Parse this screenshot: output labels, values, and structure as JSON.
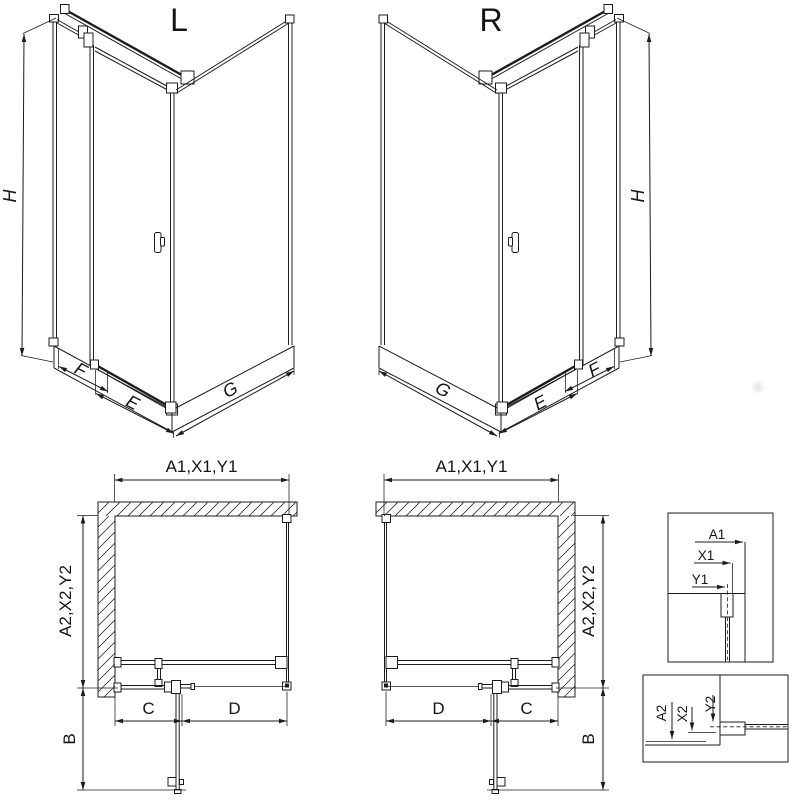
{
  "drawing": {
    "iso_left": {
      "label": "L",
      "dim_height": "H",
      "dim_side_panel": "F",
      "dim_door": "E",
      "dim_wall": "G"
    },
    "iso_right": {
      "label": "R",
      "dim_height": "H",
      "dim_side_panel": "F",
      "dim_door": "E",
      "dim_wall": "G"
    },
    "plan_left": {
      "dim_top": "A1,X1,Y1",
      "dim_side": "A2,X2,Y2",
      "dim_fixed": "C",
      "dim_door": "D",
      "dim_depth": "B"
    },
    "plan_right": {
      "dim_top": "A1,X1,Y1",
      "dim_side": "A2,X2,Y2",
      "dim_fixed": "C",
      "dim_door": "D",
      "dim_depth": "B"
    },
    "detail_top_profile": {
      "dim_a": "A1",
      "dim_x": "X1",
      "dim_y": "Y1"
    },
    "detail_side_profile": {
      "dim_a": "A2",
      "dim_x": "X2",
      "dim_y": "Y2"
    },
    "colors": {
      "line": "#1c1c1c",
      "background": "#ffffff"
    }
  }
}
